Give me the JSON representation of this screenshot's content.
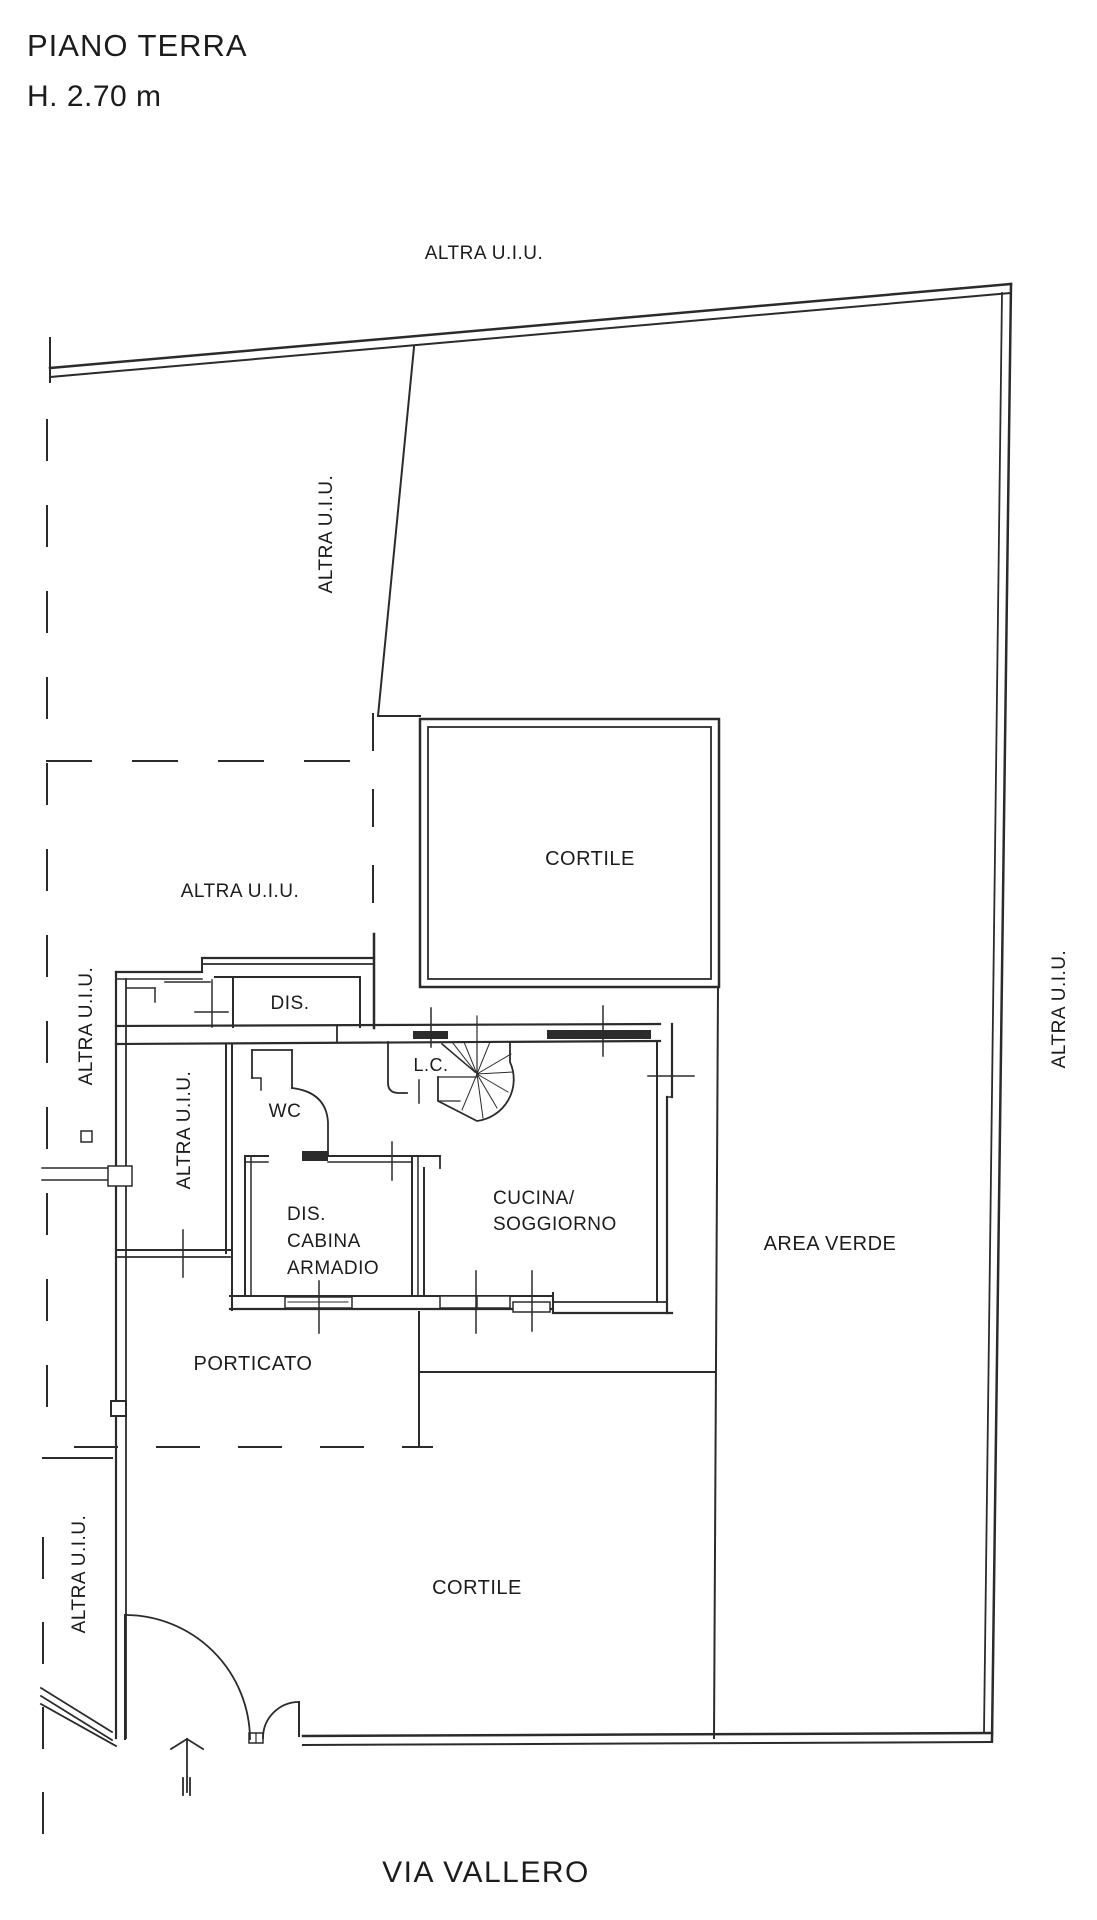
{
  "page": {
    "title_line1": "PIANO TERRA",
    "title_line2": "H. 2.70 m"
  },
  "plan": {
    "adjacent_unit_label": "ALTRA U.I.U.",
    "street_label": "VIA VALLERO",
    "rooms": {
      "cortile_upper": "CORTILE",
      "cortile_lower": "CORTILE",
      "dis": "DIS.",
      "wc": "WC",
      "lc": "L.C.",
      "cucina_soggiorno_line1": "CUCINA/",
      "cucina_soggiorno_line2": "SOGGIORNO",
      "dis_cabina_line1": "DIS.",
      "dis_cabina_line2": "CABINA",
      "dis_cabina_line3": "ARMADIO",
      "area_verde": "AREA VERDE",
      "porticato": "PORTICATO"
    }
  },
  "colors": {
    "line": "#2b2b2b",
    "text": "#1c1c1c",
    "background": "#ffffff"
  }
}
